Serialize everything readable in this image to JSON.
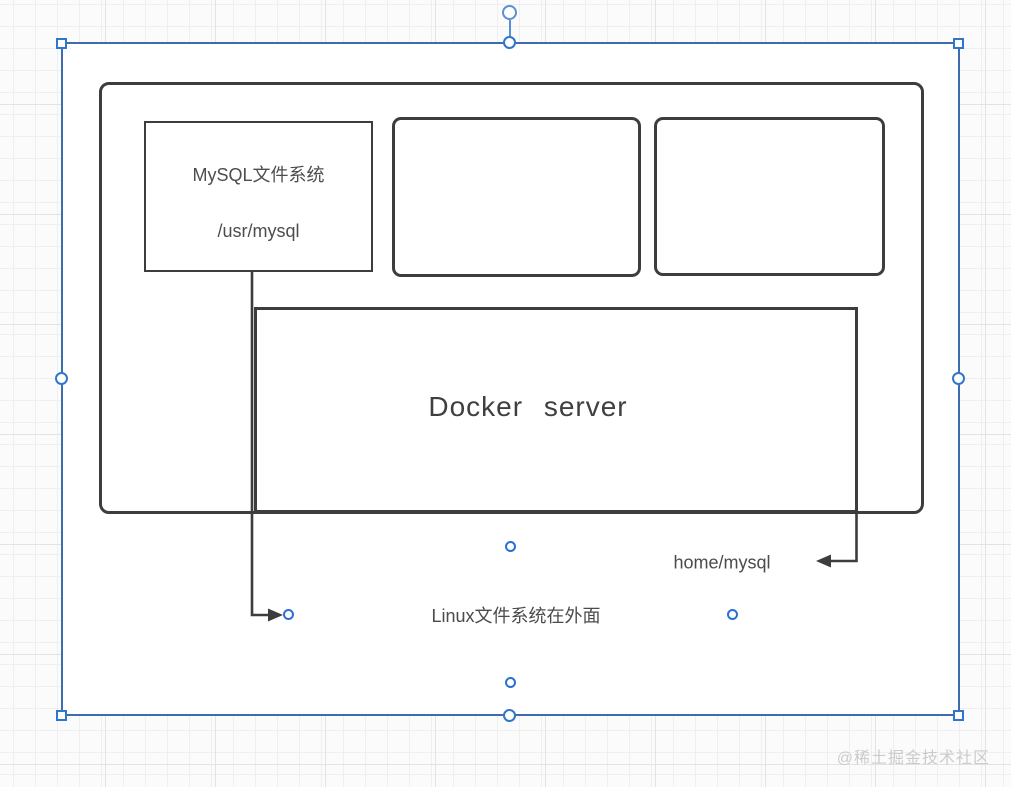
{
  "shapes": {
    "mysql_box": {
      "title": "MySQL文件系统",
      "path": "/usr/mysql"
    },
    "docker_box": {
      "label": "Docker server"
    }
  },
  "labels": {
    "home_mysql": "home/mysql",
    "linux_filesystem": "Linux文件系统在外面"
  },
  "watermark": "@稀土掘金技术社区",
  "colors": {
    "shape_stroke": "#3d3d3d",
    "selection_border": "#3f6cae",
    "handle_blue": "#2f77cc",
    "connection_point_blue": "#2a6fd6",
    "text": "#4d4d4d",
    "watermark": "#cbcbcb",
    "grid_line": "#efefef"
  }
}
